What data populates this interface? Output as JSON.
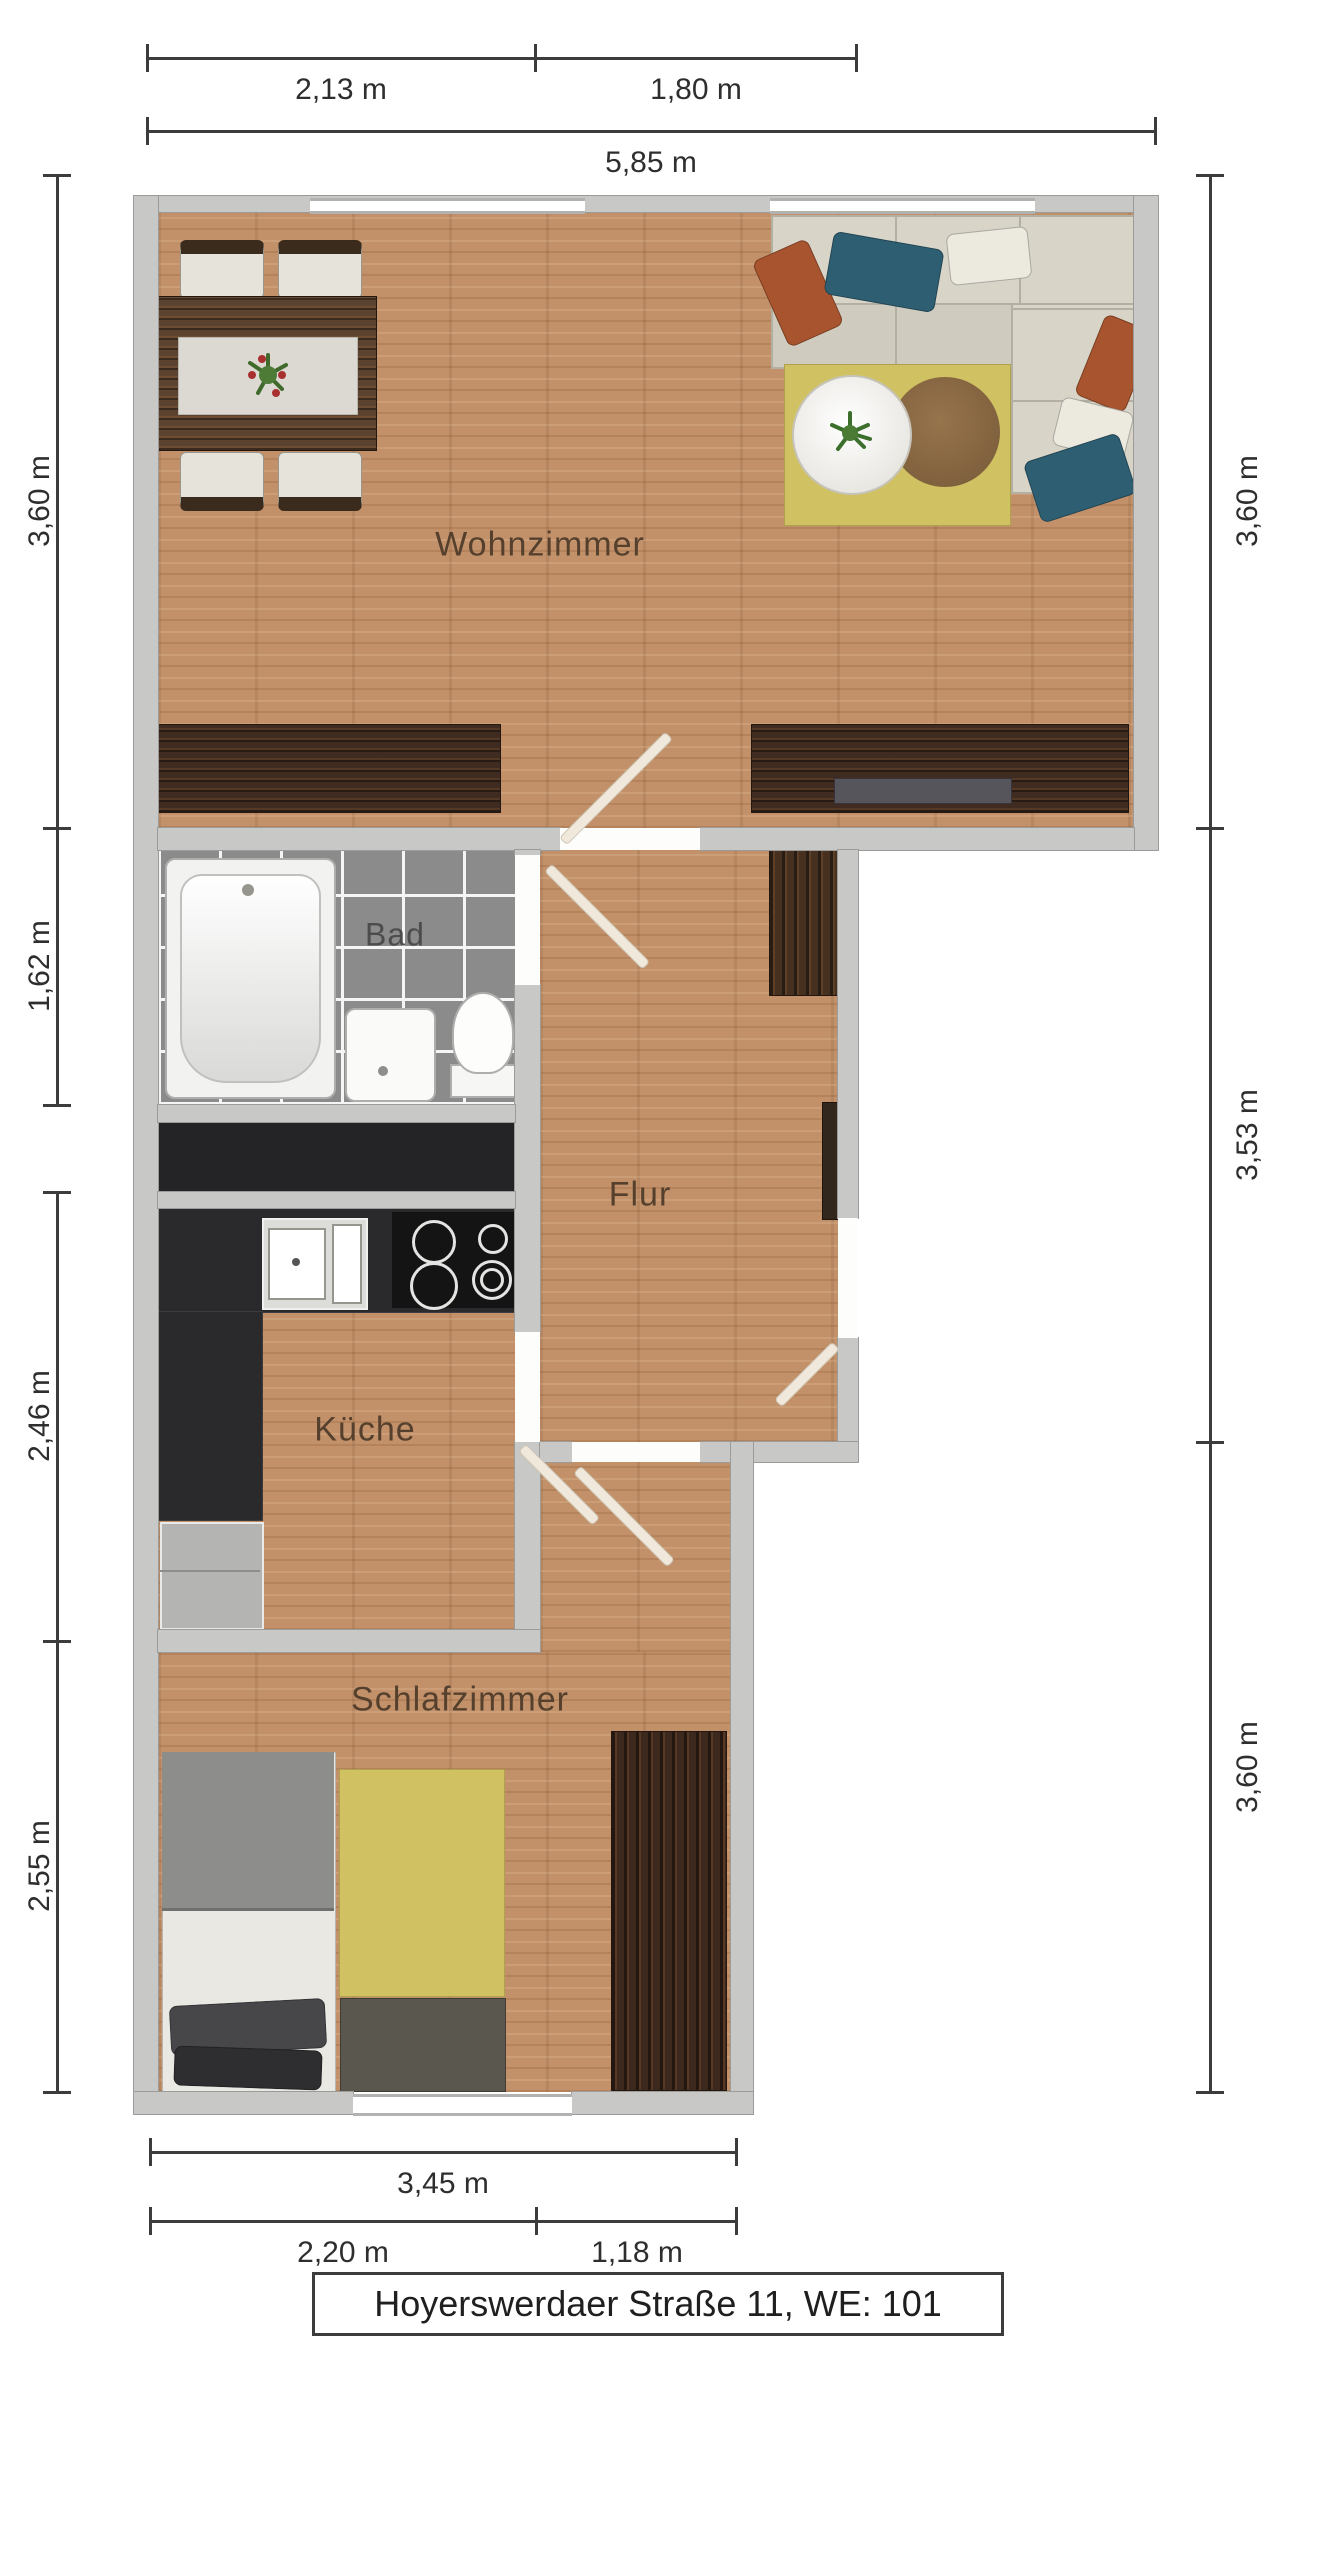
{
  "title": "Hoyerswerdaer Straße 11, WE: 101",
  "rooms": {
    "living": "Wohnzimmer",
    "bath": "Bad",
    "hall": "Flur",
    "kitchen": "Küche",
    "bedroom": "Schlafzimmer"
  },
  "dimensions": {
    "top": {
      "seg1": "2,13 m",
      "seg2": "1,80 m",
      "total": "5,85 m"
    },
    "left": {
      "living": "3,60 m",
      "bath": "1,62 m",
      "kitchen": "2,46 m",
      "bedroom": "2,55 m"
    },
    "right": {
      "living": "3,60 m",
      "hall": "3,53 m",
      "bedroom": "3,60 m"
    },
    "bottom": {
      "total": "3,45 m",
      "seg1": "2,20 m",
      "seg2": "1,18 m"
    }
  },
  "colors": {
    "wall_fill": "#c8c8c6",
    "wall_edge": "#9b9b99",
    "wood_floor": "#c2916a",
    "wood_dark": "#3f2b1f",
    "tile_gray": "#8b8b8b",
    "tile_grout": "#f5f5f5",
    "counter_dark": "#2a2a2c",
    "rug_yellow": "#d0c162",
    "sofa_cream": "#d8d5c8",
    "cushion_rust": "#a8542e",
    "cushion_teal": "#2d5e72",
    "bed_blanket": "#8d8d8b",
    "dim_color": "#3c3c3c",
    "label_color": "#55402d"
  }
}
